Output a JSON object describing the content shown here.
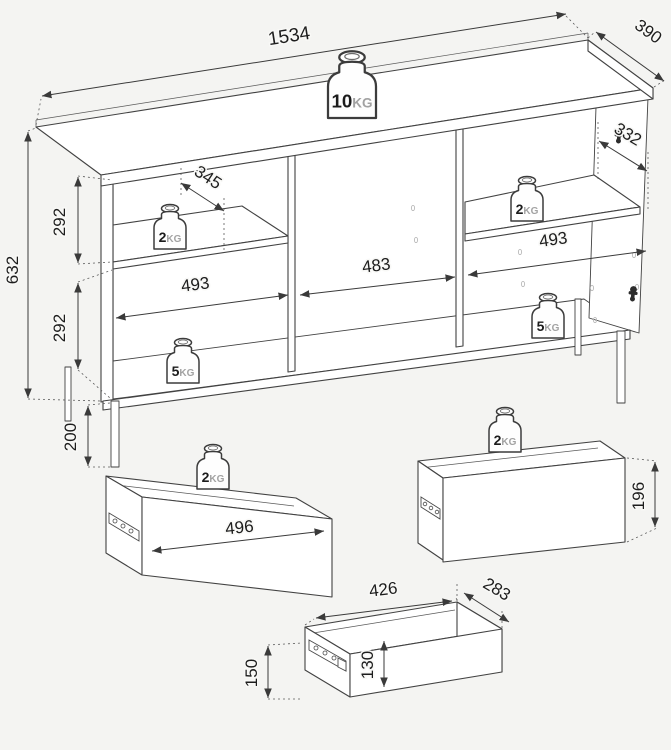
{
  "colors": {
    "background": "#f4f4f2",
    "line": "#424242",
    "text": "#1d1d1d",
    "unit_text": "#a2a2a2",
    "surface": "#ffffff"
  },
  "cabinet": {
    "dimensions": {
      "width": "1534",
      "depth": "390",
      "height": "632",
      "upper_section": "292",
      "lower_section": "292",
      "leg_height": "200",
      "shelf_depth_left": "345",
      "shelf_depth_right": "332",
      "left_width": "493",
      "center_width": "483",
      "right_width": "493"
    },
    "loads": {
      "top": {
        "value": "10",
        "unit": "KG"
      },
      "shelf": {
        "value": "2",
        "unit": "KG"
      },
      "bottom": {
        "value": "5",
        "unit": "KG"
      }
    }
  },
  "drawers": {
    "large": {
      "width": "496",
      "load": {
        "value": "2",
        "unit": "KG"
      }
    },
    "wide": {
      "height": "196",
      "load": {
        "value": "2",
        "unit": "KG"
      }
    },
    "small": {
      "width": "426",
      "depth": "283",
      "front_height": "150",
      "inner_height": "130"
    }
  }
}
